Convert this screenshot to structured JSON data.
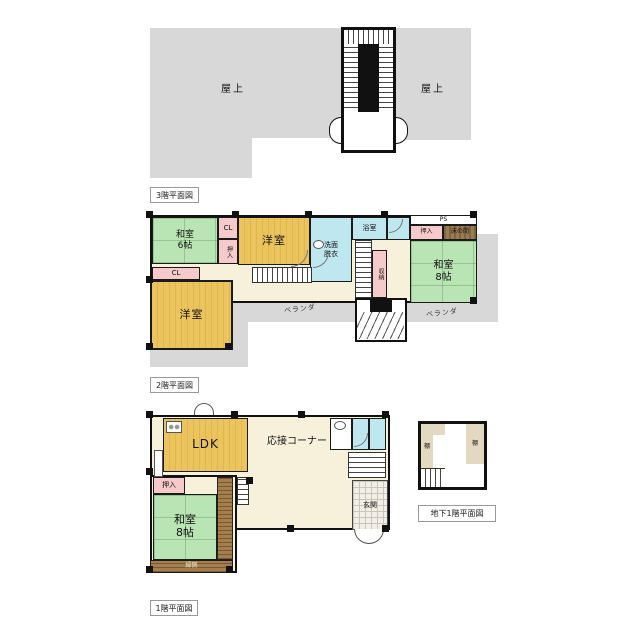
{
  "f3": {
    "caption": "3階平面図",
    "rooftop_left": "屋上",
    "rooftop_right": "屋上"
  },
  "f2": {
    "caption": "2階平面図",
    "rooms": {
      "washitsu6": "和室\n6帖",
      "cl_top": "CL",
      "oshiire_left": "押入",
      "yoshitsu_top": "洋室",
      "senmen": "洗面\n脱衣",
      "yokushitsu": "浴室",
      "shuno": "収納",
      "ps": "PS",
      "oshiire_right": "押入",
      "tokonoma": "床の間",
      "washitsu8": "和室\n8帖",
      "cl_left": "CL",
      "yoshitsu_left": "洋室",
      "veranda_left": "ベランダ",
      "veranda_right": "ベランダ"
    }
  },
  "f1": {
    "caption": "1階平面図",
    "rooms": {
      "ldk": "LDK",
      "reception": "応接コーナー",
      "oshiire": "押入",
      "washitsu8": "和室\n8帖",
      "engawa": "縁側",
      "genkan": "玄関"
    }
  },
  "b1": {
    "caption": "地下1階平面図",
    "rooms": {
      "shelf_left": "棚",
      "shelf_right": "棚"
    }
  },
  "colors": {
    "roof_gray": "#d8d8d8",
    "tatami_green": "#b9e4b4",
    "wood_orange": "#ecc45f",
    "closet_pink": "#f6caca",
    "bath_blue": "#bfe7f0",
    "hall_cream": "#f7f1dc",
    "tokonoma_brown": "#9b7c52",
    "engawa_brown": "#a57e4e",
    "wall_black": "#1a1a1a"
  }
}
